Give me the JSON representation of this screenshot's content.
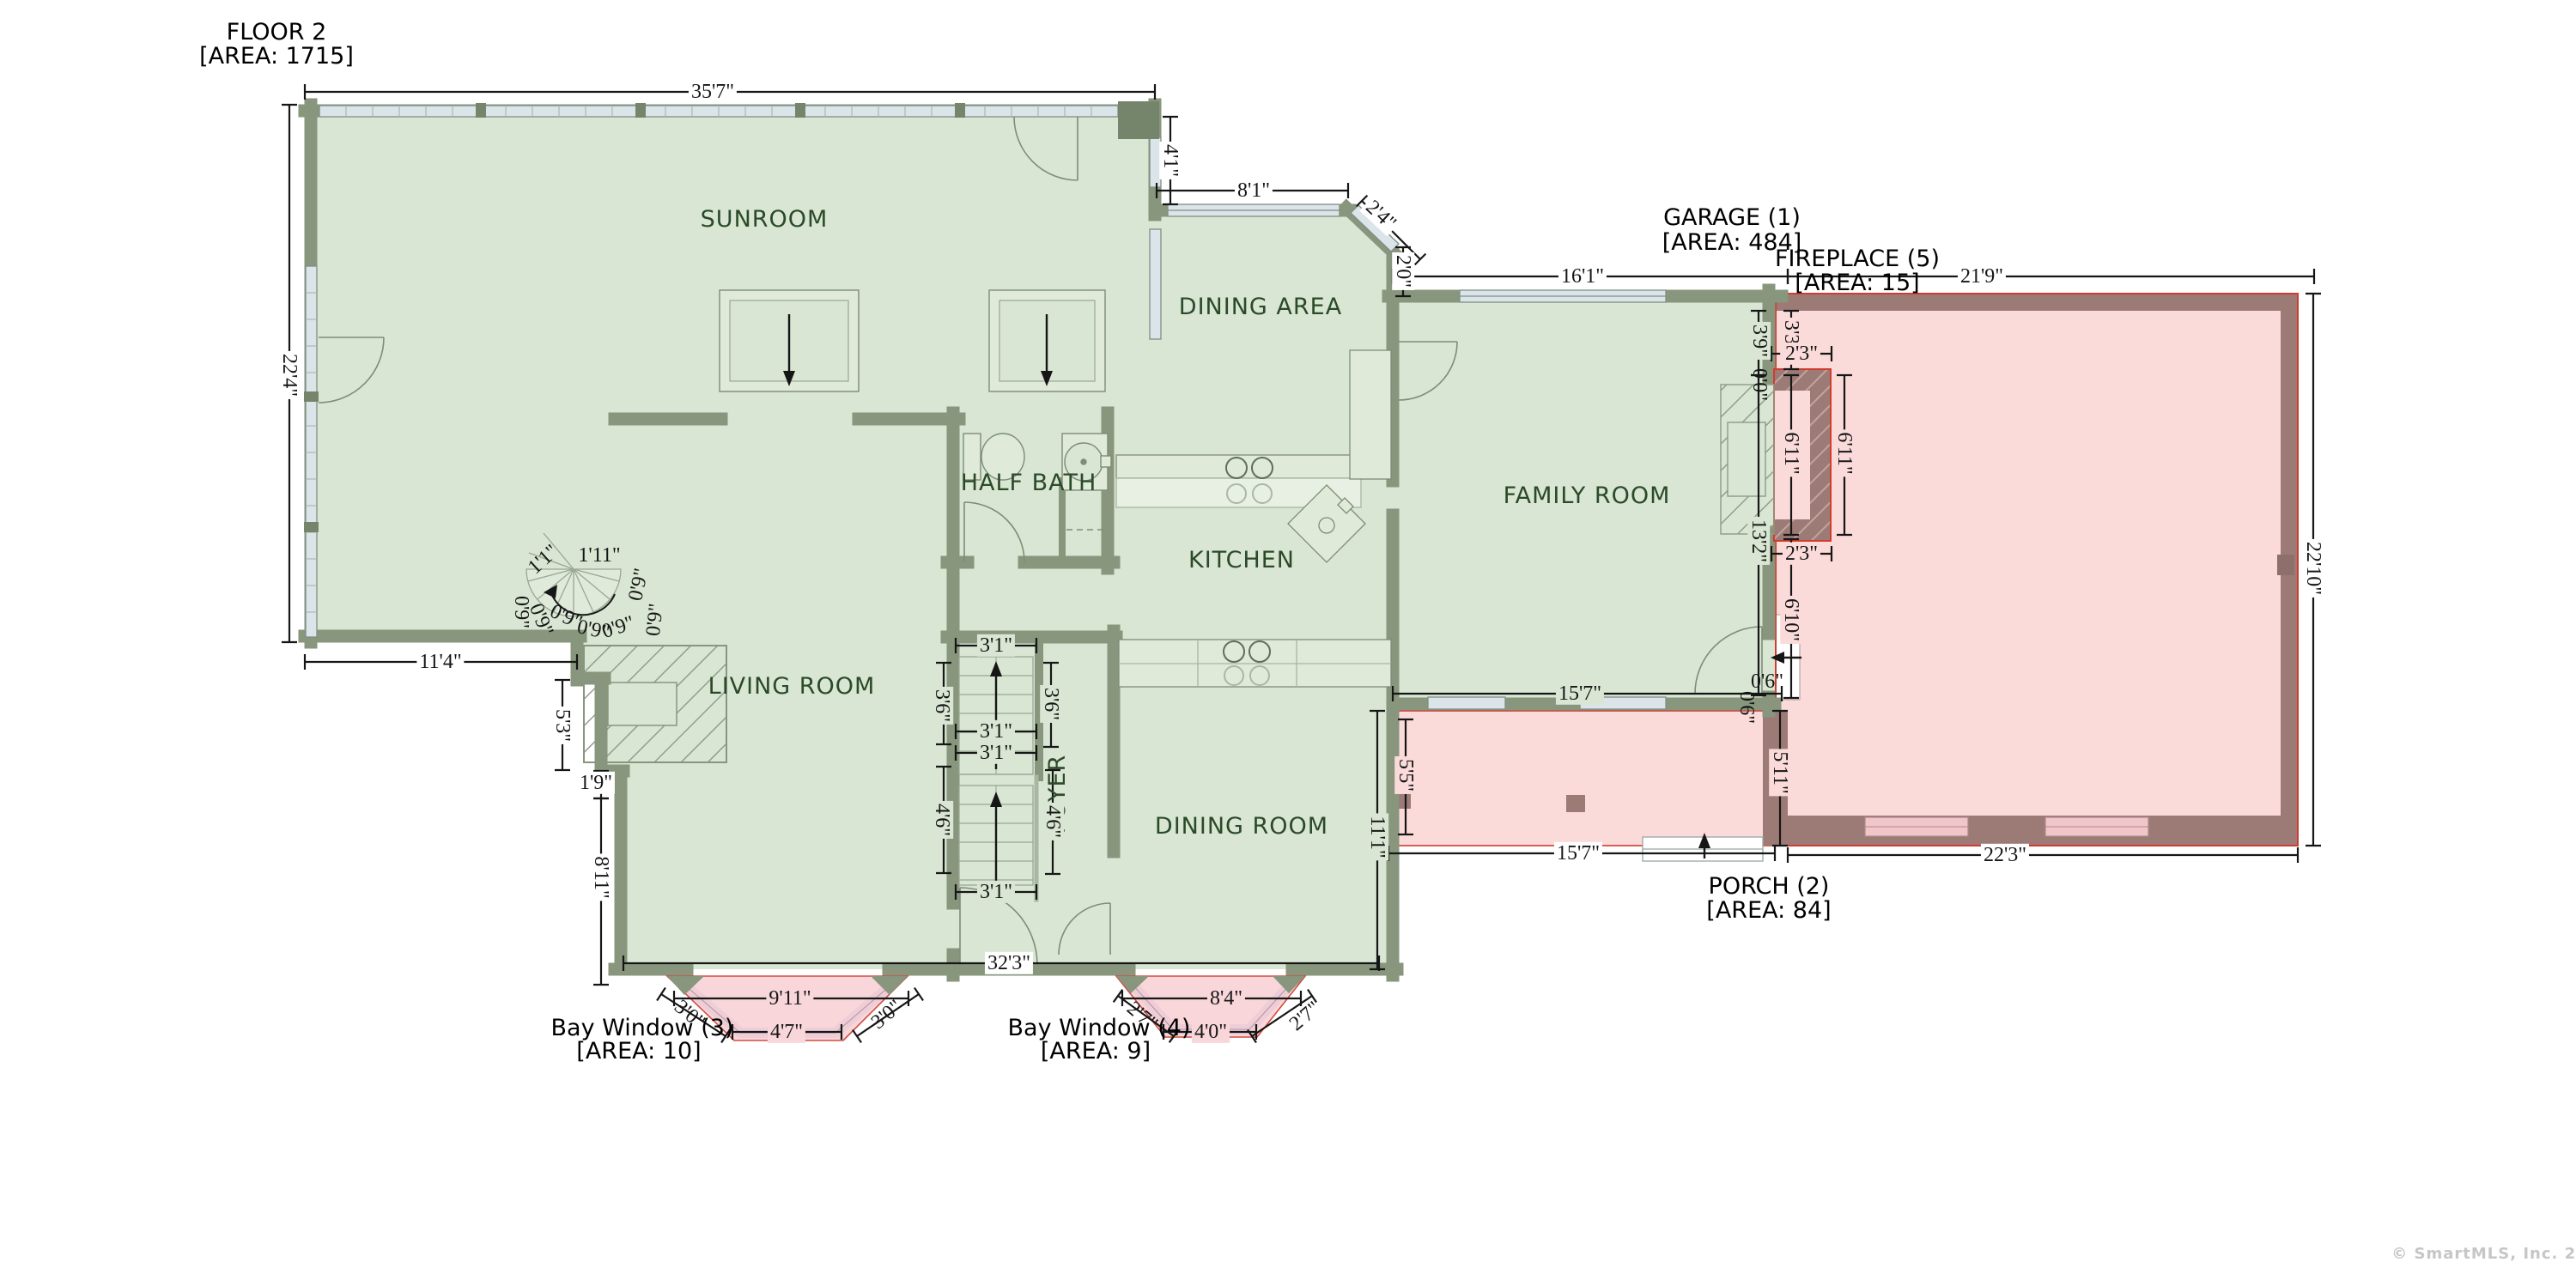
{
  "meta": {
    "watermark": "© SmartMLS, Inc. 2025"
  },
  "titles": {
    "floor": {
      "l1": "FLOOR 2",
      "l2": "[AREA: 1715]"
    },
    "garage": {
      "l1": "GARAGE (1)",
      "l2": "[AREA: 484]"
    },
    "fireplace": {
      "l1": "FIREPLACE (5)",
      "l2": "[AREA: 15]"
    },
    "porch": {
      "l1": "PORCH (2)",
      "l2": "[AREA: 84]"
    },
    "bay3": {
      "l1": "Bay Window (3)",
      "l2": "[AREA: 10]"
    },
    "bay4": {
      "l1": "Bay Window (4)",
      "l2": "[AREA: 9]"
    }
  },
  "rooms": {
    "sunroom": "SUNROOM",
    "dining_area": "DINING AREA",
    "family_room": "FAMILY ROOM",
    "half_bath": "HALF BATH",
    "kitchen": "KITCHEN",
    "living_room": "LIVING ROOM",
    "dining_room": "DINING ROOM",
    "foyer": "FOYER"
  },
  "dims": {
    "d35_7": "35'7\"",
    "d22_4": "22'4\"",
    "d11_4": "11'4\"",
    "d5_3": "5'3\"",
    "d1_9": "1'9\"",
    "d8_11": "8'11\"",
    "d32_3": "32'3\"",
    "d4_1": "4'1\"",
    "d8_1": "8'1\"",
    "d2_4": "2'4\"",
    "d2_0": "2'0\"",
    "d16_1": "16'1\"",
    "d21_9": "21'9\"",
    "d22_10": "22'10\"",
    "d22_3": "22'3\"",
    "d13_2": "13'2\"",
    "d3_9": "3'9\"",
    "d0_0": "0'0\"",
    "d3_3": "3'3\"",
    "d2_3": "2'3\"",
    "d6_11": "6'11\"",
    "d15_7": "15'7\"",
    "d5_5": "5'5\"",
    "d11_1": "11'1\"",
    "d5_11": "5'11\"",
    "d6_10": "6'10\"",
    "d0_6": "0'6\"",
    "d3_1": "3'1\"",
    "d3_6": "3'6\"",
    "d4_6": "4'6\"",
    "d1_1": "1'1\"",
    "d1_11": "1'11\"",
    "d0_9": "0'9\"",
    "d9_11": "9'11\"",
    "d3_0": "3'0\"",
    "d4_7": "4'7\"",
    "d8_4": "8'4\"",
    "d2_7": "2'7\"",
    "d4_0": "4'0\""
  },
  "colors": {
    "room_fill": "#d8e6d3",
    "wall": "#87967c",
    "exterior_fill": "#fbdada",
    "exterior_wall": "#9c7b76",
    "outline_red": "#d23b2e",
    "window": "#dbe4e8",
    "room_label": "#2b4a28",
    "dim_text": "#161616",
    "watermark": "#c6c6c6"
  }
}
